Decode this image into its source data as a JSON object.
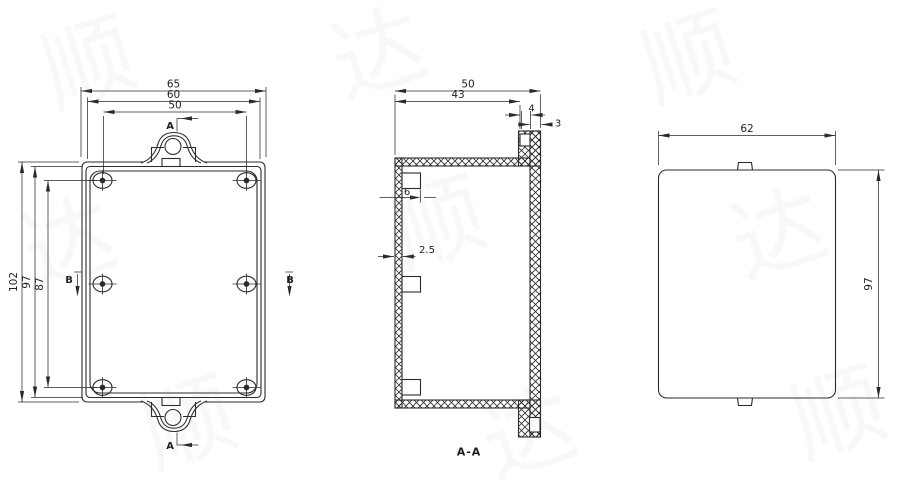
{
  "drawing": {
    "front_view": {
      "dim_width_overall": "65",
      "dim_width_lid": "60",
      "dim_hole_pitch_h": "50",
      "dim_height_overall": "102",
      "dim_height_lid": "97",
      "dim_hole_pitch_v": "87",
      "section_marker_a": "A",
      "section_marker_b": "B"
    },
    "section_view": {
      "dim_depth_overall": "50",
      "dim_depth_inner": "43",
      "dim_flange_step": "4",
      "dim_back_wall": "3",
      "dim_boss": "6",
      "dim_wall_thickness": "2.5",
      "label": "A-A"
    },
    "side_view": {
      "dim_width": "62",
      "dim_height": "97"
    },
    "colors": {
      "line": "#2b2b2b",
      "background": "#ffffff"
    },
    "watermark": {
      "chars": [
        "顺",
        "达"
      ]
    }
  }
}
